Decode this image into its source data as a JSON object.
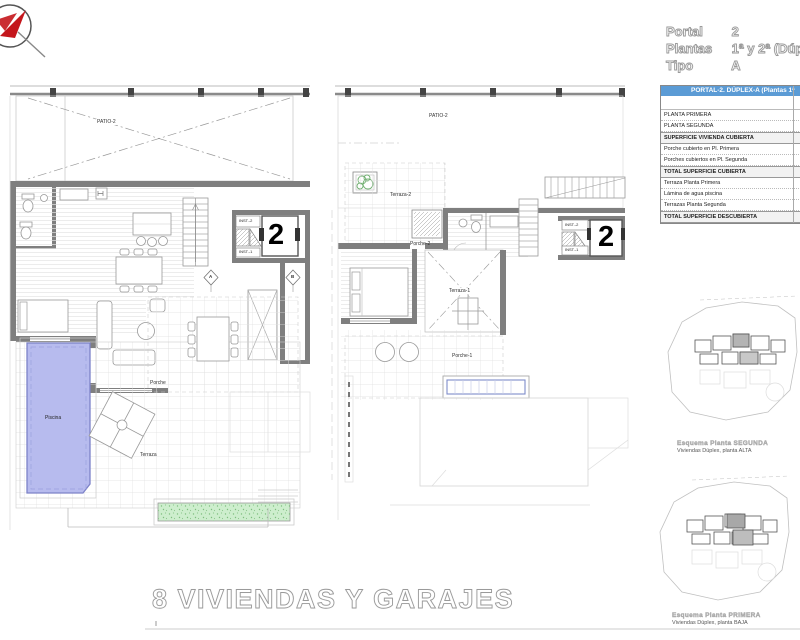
{
  "header": {
    "rows": [
      {
        "label": "Portal",
        "value": "2"
      },
      {
        "label": "Plantas",
        "value": "1ª y 2ª (Dúp"
      },
      {
        "label": "Tipo",
        "value": "A"
      }
    ]
  },
  "surface_table": {
    "title": "PORTAL-2. DÚPLEX-A (Plantas 1ª",
    "rows": [
      {
        "label": "PLANTA PRIMERA"
      },
      {
        "label": "PLANTA SEGUNDA"
      },
      {
        "label": "SUPERFICIE VIVIENDA CUBIERTA"
      },
      {
        "label": "Porche cubierto en Pl. Primera"
      },
      {
        "label": "Porches cubiertos en Pl. Segunda"
      },
      {
        "label": "TOTAL SUPERFICIE CUBIERTA"
      },
      {
        "label": "Terraza Planta Primera"
      },
      {
        "label": "Lámina de agua piscina"
      },
      {
        "label": "Terrazas Planta Segunda"
      },
      {
        "label": "TOTAL SUPERFICIE DESCUBIERTA"
      }
    ]
  },
  "plan_left": {
    "patio": "PATIO-2",
    "porche": "Porche",
    "terraza": "Terraza",
    "piscina": "Piscina",
    "inst_top": "INST.-2",
    "inst_bottom": "INST.-1",
    "portal_number": "2",
    "marker_a": "A",
    "marker_b": "B"
  },
  "plan_right": {
    "patio": "PATIO-2",
    "terraza2": "Terraza-2",
    "porche2": "Porche-2",
    "terraza1": "Terraza-1",
    "porche1": "Porche-1",
    "inst_top": "INST.-2",
    "inst_bottom": "INST.-1",
    "portal_number": "2"
  },
  "site_plans": {
    "upper": {
      "caption_title": "Esquema Planta SEGUNDA",
      "caption_sub": "Viviendas Dúplex, planta ALTA"
    },
    "lower": {
      "caption_title": "Esquema Planta PRIMERA",
      "caption_sub": "Viviendas Dúplex, planta BAJA"
    }
  },
  "footer": {
    "project_title": "8 VIVIENDAS Y GARAJES"
  },
  "colors": {
    "pool": "#b7bbee",
    "pool_border": "#7d82c8",
    "planter_green": "#cdeecd",
    "tree_green": "#6fae6f",
    "table_header_bg": "#5b9bd5",
    "wall_grey": "#7f7f7f",
    "logo_red": "#c4161c"
  }
}
